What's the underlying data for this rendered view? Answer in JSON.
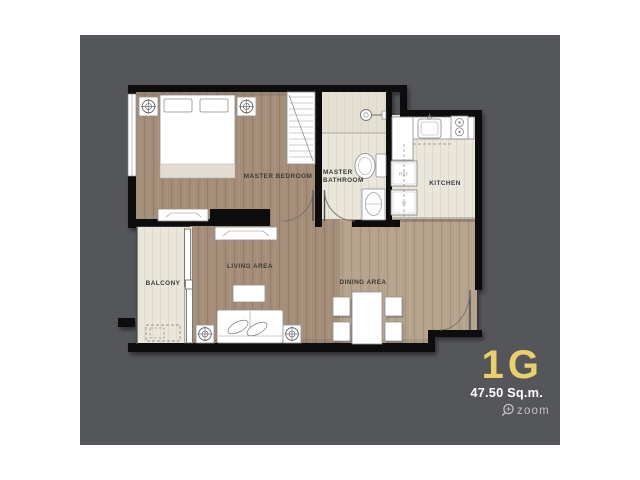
{
  "page": {
    "background": "#ffffff",
    "canvas": "#55565a"
  },
  "unit": {
    "name": "1G",
    "area": "47.50 Sq.m."
  },
  "zoom_control": {
    "label": "zoom"
  },
  "rooms": {
    "master_bedroom": {
      "label": "MASTER BEDROOM"
    },
    "master_bathroom": {
      "line1": "MASTER",
      "line2": "BATHROOM"
    },
    "kitchen": {
      "label": "KITCHEN"
    },
    "living": {
      "label": "LIVING AREA"
    },
    "dining": {
      "label": "DINING AREA"
    },
    "balcony": {
      "label": "BALCONY"
    }
  },
  "appliances": {
    "refrigerator": "REF",
    "washer": "W"
  },
  "palette": {
    "wall": "#0d0d0d",
    "wood": "#a58e79",
    "wood_light": "#b5a38d",
    "cream": "#eae6da",
    "label": "#3a3a3a",
    "unit_name": "#e9d06a",
    "unit_area": "#ffffff",
    "zoom": "#c2c2c2"
  }
}
